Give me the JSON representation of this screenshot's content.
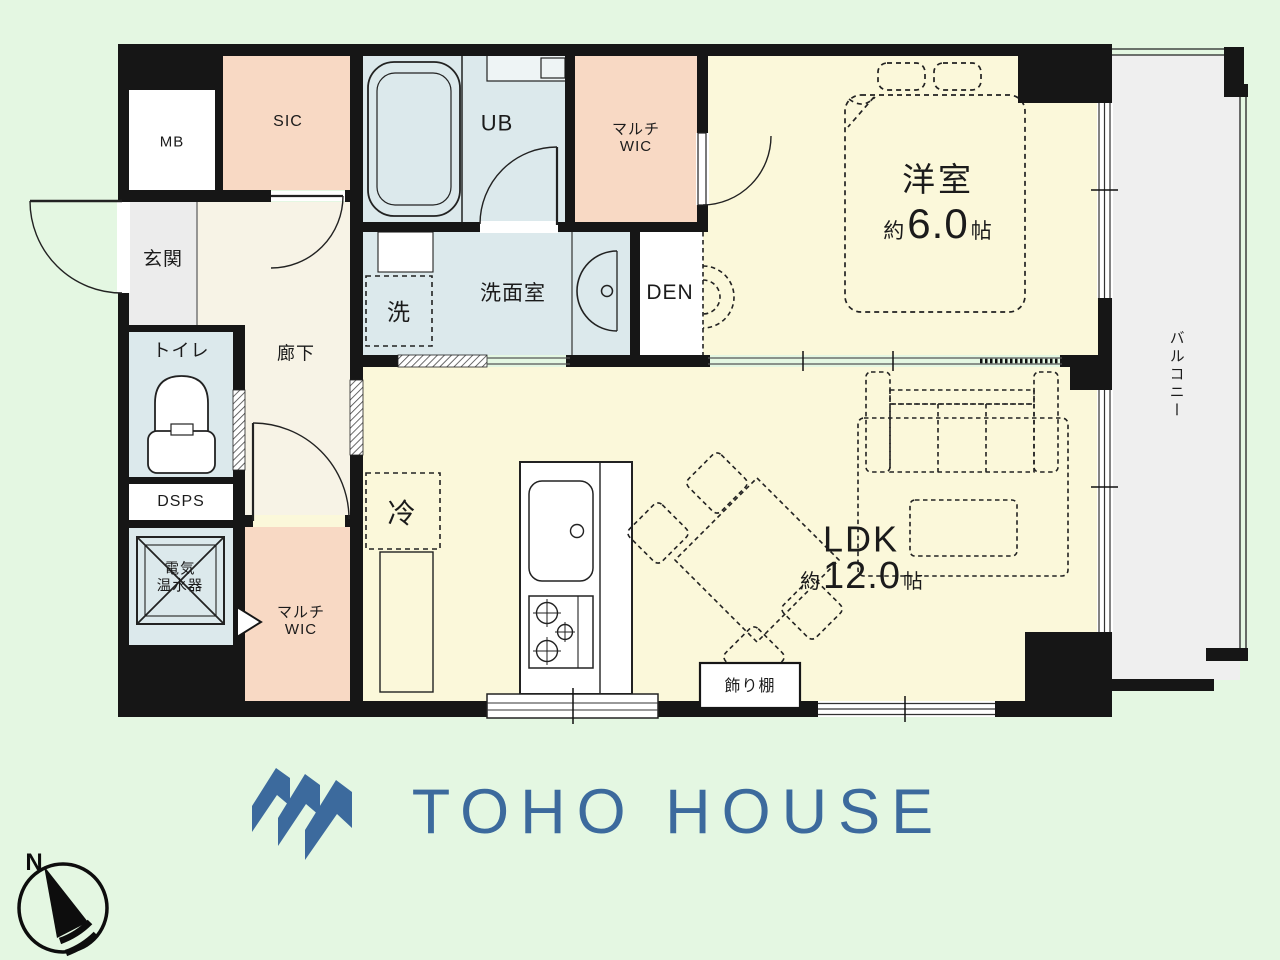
{
  "floor_plan": {
    "rooms": {
      "mb": {
        "label": "MB"
      },
      "sic": {
        "label": "SIC"
      },
      "ub": {
        "label": "UB"
      },
      "multi_wic_top": {
        "line1": "マルチ",
        "line2": "WIC"
      },
      "western_room": {
        "name": "洋室",
        "size_prefix": "約",
        "size_value": "6.0",
        "size_unit": "帖"
      },
      "den": {
        "label": "DEN"
      },
      "washroom": {
        "label": "洗面室"
      },
      "washer_space": {
        "label": "洗"
      },
      "entrance": {
        "label": "玄関"
      },
      "hallway": {
        "label": "廊下"
      },
      "toilet": {
        "label": "トイレ"
      },
      "dsps": {
        "label": "DSPS"
      },
      "water_heater": {
        "line1": "電気",
        "line2": "温水器"
      },
      "multi_wic_bottom": {
        "line1": "マルチ",
        "line2": "WIC"
      },
      "refrigerator_space": {
        "label": "冷"
      },
      "ldk": {
        "name": "LDK",
        "size_prefix": "約",
        "size_value": "12.0",
        "size_unit": "帖"
      },
      "display_shelf": {
        "label": "飾り棚"
      },
      "balcony": {
        "label": "バルコニー"
      }
    },
    "compass": {
      "north_label": "N"
    }
  },
  "branding": {
    "company_name": "TOHO HOUSE"
  },
  "colors": {
    "wall": "#161616",
    "room_cream": "#fbf8da",
    "room_peach": "#f8d9c4",
    "room_blue": "#dce9ec",
    "entrance_gray": "#ececec",
    "balcony_gray": "#efefef",
    "background_green": "#e4f7e2",
    "brand_blue": "#3c6a9d"
  }
}
